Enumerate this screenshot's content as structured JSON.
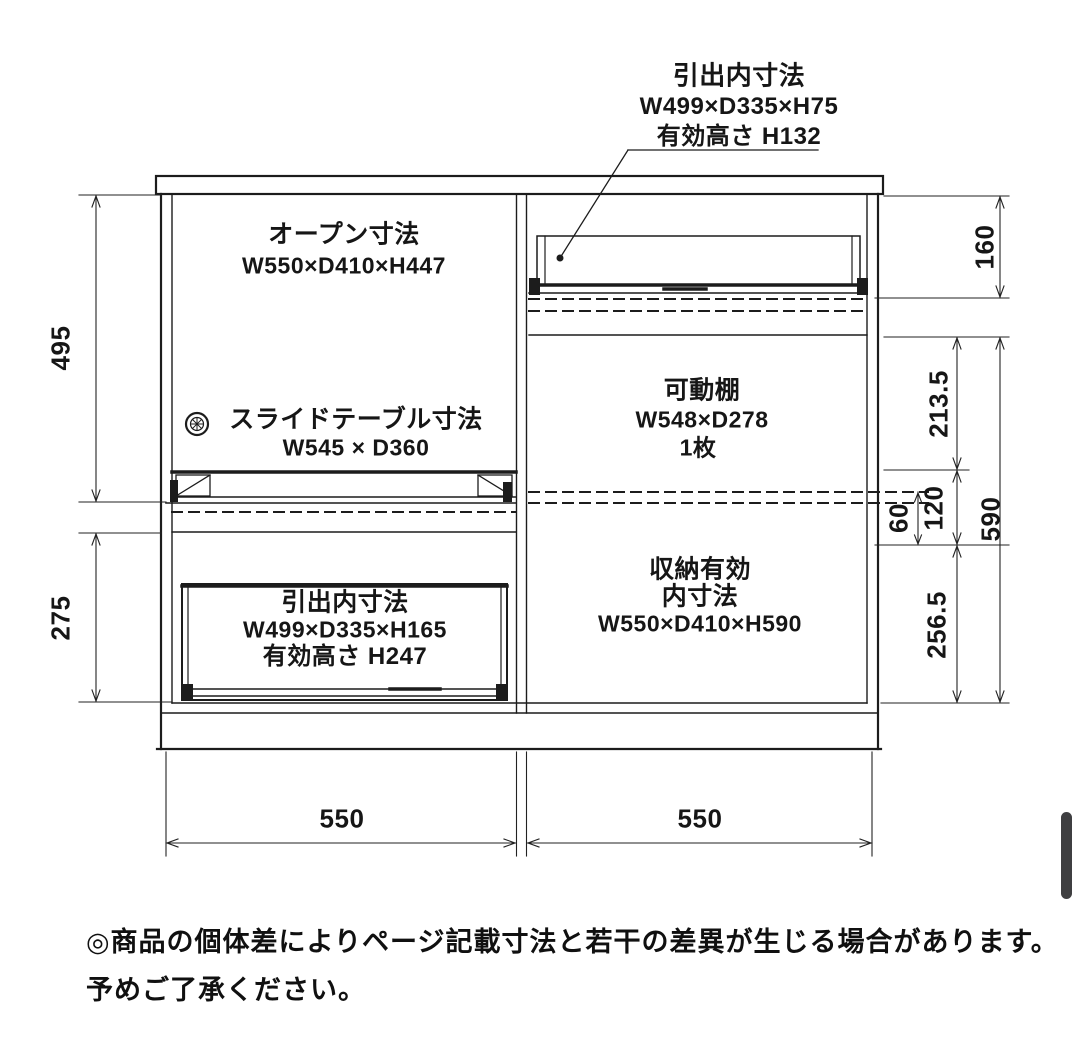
{
  "annotation": {
    "line1": "引出内寸法",
    "line2": "W499×D335×H75",
    "line3": "有効高さ H132"
  },
  "sections": {
    "open": {
      "title": "オープン寸法",
      "size": "W550×D410×H447"
    },
    "slide_table": {
      "title": "スライドテーブル寸法",
      "size": "W545 × D360"
    },
    "drawer": {
      "title": "引出内寸法",
      "size": "W499×D335×H165",
      "note": "有効高さ H247"
    },
    "shelf": {
      "title": "可動棚",
      "size": "W548×D278",
      "count": "1枚"
    },
    "storage": {
      "title_line1": "収納有効",
      "title_line2": "内寸法",
      "size": "W550×D410×H590"
    }
  },
  "dims": {
    "left_upper": "495",
    "left_lower": "275",
    "right_flap": "160",
    "right_upper": "213.5",
    "right_pitch": "120",
    "right_half_pitch": "60",
    "right_inner_total": "590",
    "right_lower": "256.5",
    "width_left": "550",
    "width_right": "550"
  },
  "footer": {
    "line1": "◎商品の個体差によりページ記載寸法と若干の差異が生じる場合があります。",
    "line2": "予めご了承ください。"
  },
  "colors": {
    "line": "#1c1c1c",
    "scrollbar": "#3f3f41"
  }
}
